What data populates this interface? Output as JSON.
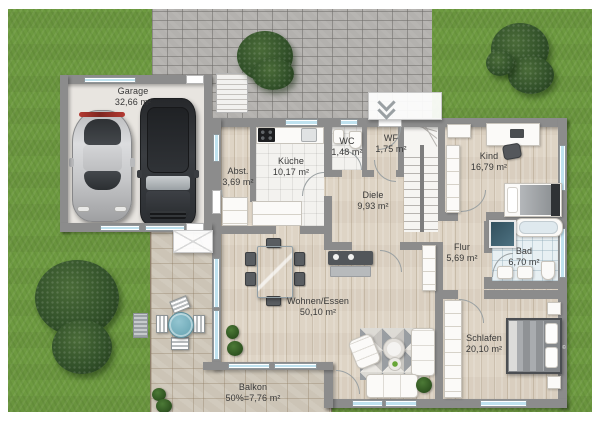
{
  "plan": {
    "rooms": {
      "garage": {
        "name": "Garage",
        "area": "32,66 m²"
      },
      "kueche": {
        "name": "Küche",
        "area": "10,17 m²"
      },
      "abstellraum": {
        "name": "Abst.",
        "area": "3,69 m²"
      },
      "wc": {
        "name": "WC",
        "area": "1,48 m²"
      },
      "windfang": {
        "name": "WF",
        "area": "1,75 m²"
      },
      "diele": {
        "name": "Diele",
        "area": "9,93 m²"
      },
      "kind": {
        "name": "Kind",
        "area": "16,79 m²"
      },
      "flur": {
        "name": "Flur",
        "area": "5,69 m²"
      },
      "bad": {
        "name": "Bad",
        "area": "6,70 m²"
      },
      "wohnen_essen": {
        "name": "Wohnen/Essen",
        "area": "50,10 m²"
      },
      "schlafen": {
        "name": "Schlafen",
        "area": "20,10 m²"
      },
      "balkon": {
        "name": "Balkon",
        "area": "50%=7,76 m²"
      }
    },
    "watermark": "©",
    "palette": {
      "grass": "#6d9a40",
      "paving": "#b3b1ae",
      "terrace_stone": "#ccc4b6",
      "wall": "#8c8c8c",
      "wood_floor": "#ded4c5",
      "white_tile": "#f3f2ef",
      "bath_tile": "#e8f0f3",
      "window_glass": "#bfe2ef",
      "label_text": "#383838"
    }
  }
}
